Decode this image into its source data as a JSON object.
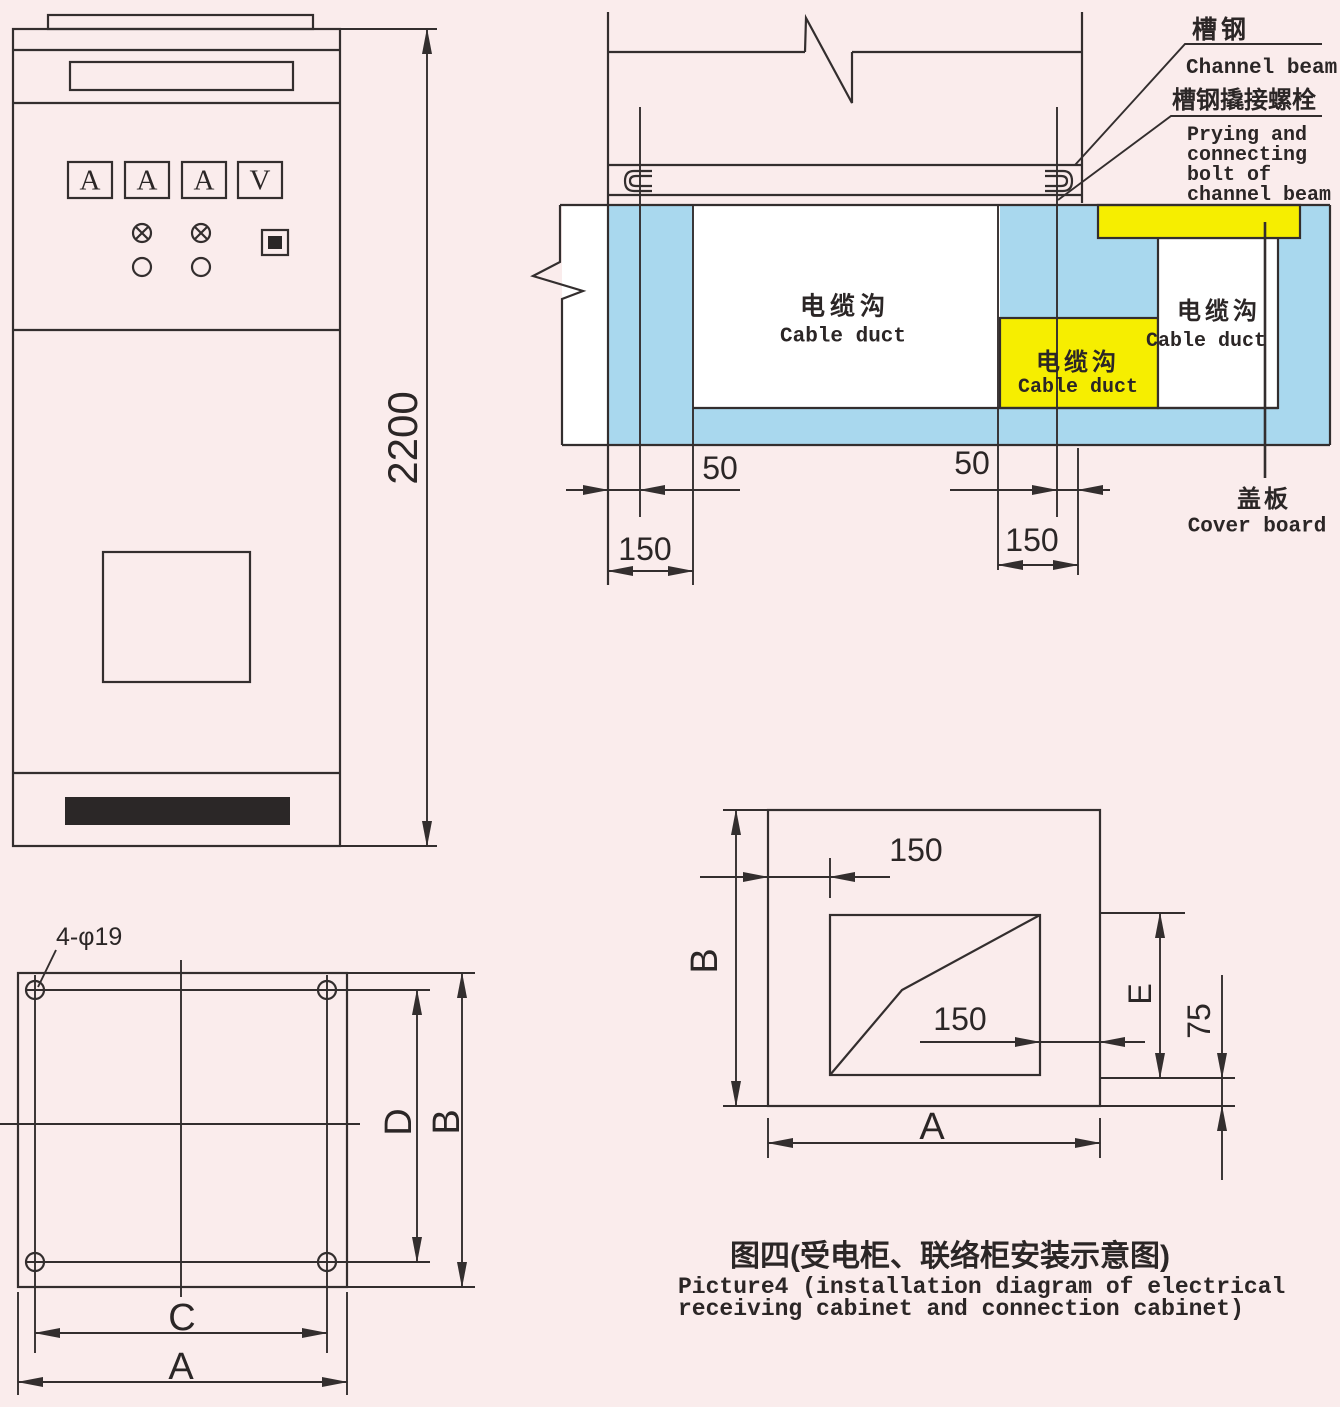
{
  "colors": {
    "background": "#faecec",
    "concrete_blue": "#a9d8ee",
    "highlight_yellow": "#f6ee00",
    "line": "#332e2e",
    "grille_black": "#2b2727"
  },
  "front_view": {
    "meters": [
      "A",
      "A",
      "A",
      "V"
    ],
    "height_dim": "2200"
  },
  "section_view": {
    "channel_beam_cn": "槽钢",
    "channel_beam_en": "Channel beam",
    "bolt_cn": "槽钢撬接螺栓",
    "bolt_en_line1": "Prying and",
    "bolt_en_line2": "connecting",
    "bolt_en_line3": "bolt of",
    "bolt_en_line4": "channel beam",
    "duct_cn": "电缆沟",
    "duct_en": "Cable duct",
    "cover_cn": "盖板",
    "cover_en": "Cover board",
    "dim_left_50": "50",
    "dim_left_150": "150",
    "dim_right_50": "50",
    "dim_right_150": "150"
  },
  "plan_left": {
    "holes_label": "4-φ19",
    "dim_c": "C",
    "dim_a": "A",
    "dim_d": "D",
    "dim_b": "B"
  },
  "plan_right": {
    "dim_150_top": "150",
    "dim_150_mid": "150",
    "dim_b": "B",
    "dim_e": "E",
    "dim_75": "75",
    "dim_a": "A"
  },
  "caption": {
    "title_cn": "图四(受电柜、联络柜安装示意图)",
    "title_en_line1": "Picture4 (installation diagram of electrical",
    "title_en_line2": "receiving cabinet and connection cabinet)"
  }
}
